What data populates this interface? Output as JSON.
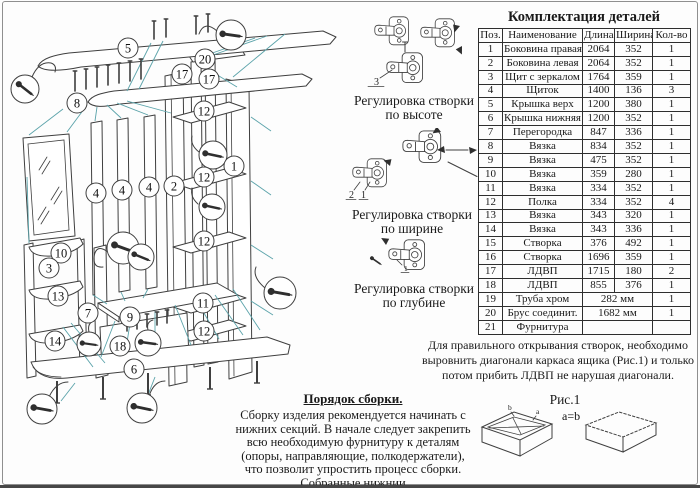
{
  "parts_table": {
    "title": "Комплектация деталей",
    "headers": [
      "Поз.",
      "Наименование",
      "Длина",
      "Ширина",
      "Кол-во"
    ],
    "rows": [
      [
        "1",
        "Боковина правая",
        "2064",
        "352",
        "1"
      ],
      [
        "2",
        "Боковина левая",
        "2064",
        "352",
        "1"
      ],
      [
        "3",
        "Щит с зеркалом",
        "1764",
        "359",
        "1"
      ],
      [
        "4",
        "Щиток",
        "1400",
        "136",
        "3"
      ],
      [
        "5",
        "Крышка верх",
        "1200",
        "380",
        "1"
      ],
      [
        "6",
        "Крышка нижняя",
        "1200",
        "352",
        "1"
      ],
      [
        "7",
        "Перегородка",
        "847",
        "336",
        "1"
      ],
      [
        "8",
        "Вязка",
        "834",
        "352",
        "1"
      ],
      [
        "9",
        "Вязка",
        "475",
        "352",
        "1"
      ],
      [
        "10",
        "Вязка",
        "359",
        "280",
        "1"
      ],
      [
        "11",
        "Вязка",
        "334",
        "352",
        "1"
      ],
      [
        "12",
        "Полка",
        "334",
        "352",
        "4"
      ],
      [
        "13",
        "Вязка",
        "343",
        "320",
        "1"
      ],
      [
        "14",
        "Вязка",
        "343",
        "336",
        "1"
      ],
      [
        "15",
        "Створка",
        "376",
        "492",
        "1"
      ],
      [
        "16",
        "Створка",
        "1696",
        "359",
        "1"
      ],
      [
        "17",
        "ЛДВП",
        "1715",
        "180",
        "2"
      ],
      [
        "18",
        "ЛДВП",
        "855",
        "376",
        "1"
      ],
      [
        "19",
        "Труба хром",
        "282 мм",
        "1"
      ],
      [
        "20",
        "Брус соединит.",
        "1682 мм",
        "1"
      ],
      [
        "21",
        "Фурнитура",
        "",
        ""
      ]
    ]
  },
  "adjust_sections": [
    {
      "caption_line1": "Регулировка створки",
      "caption_line2": "по высоте",
      "part_labels": [
        "3"
      ]
    },
    {
      "caption_line1": "Регулировка створки",
      "caption_line2": "по ширине",
      "part_labels": [
        "2",
        "1"
      ]
    },
    {
      "caption_line1": "Регулировка створки",
      "caption_line2": "по глубине",
      "part_labels": [
        "1"
      ]
    }
  ],
  "drawing": {
    "callouts": [
      "5",
      "20",
      "17",
      "17",
      "8",
      "12",
      "1",
      "12",
      "2",
      "4",
      "4",
      "4",
      "12",
      "10",
      "3",
      "13",
      "11",
      "7",
      "9",
      "12",
      "14",
      "18",
      "6"
    ]
  },
  "note": "Для правильного открывания  створок, необходимо выровнить диагонали каркаса ящика (Рис.1) и только потом прибить ЛДВП не нарушая диагонали.",
  "figure": {
    "title": "Рис.1",
    "equation": "a=b",
    "diag_labels": [
      "b",
      "a"
    ]
  },
  "assembly": {
    "title": "Порядок сборки.",
    "body": "Сборку изделия рекомендуется начинать с нижних секций. В начале следует закрепить всю необходимую фурнитуру к деталям (опоры, направляющие, полкодержатели), что позволит упростить процесс сборки. Собранные нижнии"
  },
  "colors": {
    "leader": "#5ba3aa",
    "line": "#3f3f3f"
  }
}
